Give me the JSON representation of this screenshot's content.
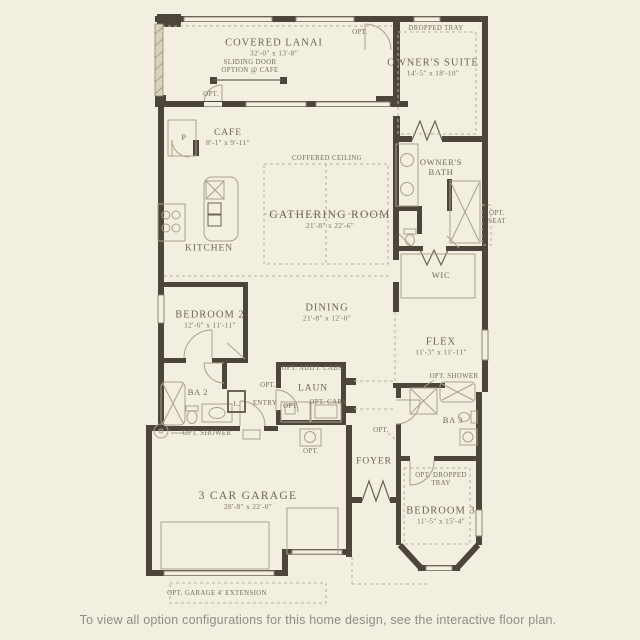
{
  "palette": {
    "background": "#f2efe1",
    "wall": "#4c453b",
    "fixture_line": "#a9a08b",
    "dashed_line": "#b8af99",
    "label_text": "#6e6557",
    "caption_text": "#8e8d86",
    "screen_wall": "#d9d2ba"
  },
  "rooms": [
    {
      "id": "covered-lanai",
      "name": "COVERED LANAI",
      "dims": "32'-0\" x 13'-8\""
    },
    {
      "id": "owners-suite",
      "name": "OWNER'S SUITE",
      "dims": "14'-5\" x 18'-10\""
    },
    {
      "id": "cafe",
      "name": "CAFE",
      "dims": "8'-1\" x 9'-11\""
    },
    {
      "id": "gathering-room",
      "name": "GATHERING ROOM",
      "dims": "21'-8\" x 22'-6\""
    },
    {
      "id": "kitchen",
      "name": "KITCHEN",
      "dims": ""
    },
    {
      "id": "owners-bath",
      "name": "OWNER'S BATH",
      "dims": ""
    },
    {
      "id": "wic",
      "name": "WIC",
      "dims": ""
    },
    {
      "id": "bedroom-2",
      "name": "BEDROOM 2",
      "dims": "12'-6\" x 11'-11\""
    },
    {
      "id": "dining",
      "name": "DINING",
      "dims": "21'-8\" x 12'-0\""
    },
    {
      "id": "flex",
      "name": "FLEX",
      "dims": "11'-3\" x 11'-11\""
    },
    {
      "id": "ba-2",
      "name": "BA 2",
      "dims": ""
    },
    {
      "id": "laun",
      "name": "LAUN",
      "dims": ""
    },
    {
      "id": "ba-3",
      "name": "BA 3",
      "dims": ""
    },
    {
      "id": "foyer",
      "name": "FOYER",
      "dims": ""
    },
    {
      "id": "garage",
      "name": "3 CAR GARAGE",
      "dims": "28'-8\" x 22'-0\""
    },
    {
      "id": "bedroom-3",
      "name": "BEDROOM 3",
      "dims": "11'-5\" x 15'-4\""
    }
  ],
  "labels": {
    "dropped_tray": "DROPPED TRAY",
    "coffered_ceiling": "COFFERED CEILING",
    "sliding_1": "SLIDING DOOR",
    "sliding_2": "OPTION @ CAFE",
    "opt": "OPT.",
    "opt_seat_1": "OPT.",
    "opt_seat_2": "SEAT",
    "opt_shower": "OPT. SHOWER",
    "opt_addl_cabs": "OPT. ADD'L CABS.",
    "opt_cabs": "OPT. CABS",
    "opt_dropped_1": "OPT. DROPPED",
    "opt_dropped_2": "TRAY",
    "opt_garage_ext": "OPT. GARAGE 4' EXTENSION",
    "pantry": "P",
    "linen": "L.",
    "entry": "ENTRY"
  },
  "caption": "To view all option configurations for this home design, see the interactive floor plan."
}
